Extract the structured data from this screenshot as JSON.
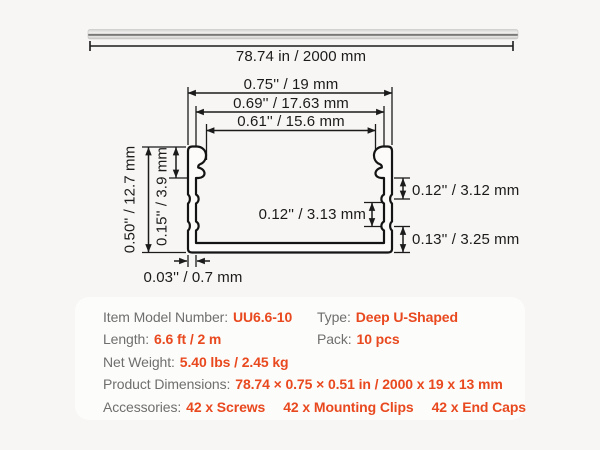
{
  "colors": {
    "background": "#F7F6F4",
    "panel": "#FCFCFA",
    "accent_orange": "#E9491F",
    "label_gray": "#6F6F6F",
    "line_ink": "#1B1B1B"
  },
  "diagram": {
    "length_label": "78.74 in / 2000 mm",
    "dims": {
      "width_outer": "0.75'' / 19 mm",
      "width_mid": "0.69'' / 17.63 mm",
      "width_inner": "0.61'' / 15.6 mm",
      "height_outer": "0.50'' / 12.7 mm",
      "flange_height": "0.15'' / 3.9 mm",
      "wall_thickness": "0.03'' / 0.7 mm",
      "seg_top_right": "0.12'' / 3.12 mm",
      "seg_mid": "0.12'' / 3.13 mm",
      "seg_bottom_right": "0.13'' / 3.25 mm"
    }
  },
  "specs": {
    "model": {
      "label": "Item Model Number:",
      "value": "UU6.6-10"
    },
    "type": {
      "label": "Type:",
      "value": "Deep U-Shaped"
    },
    "length": {
      "label": "Length:",
      "value": "6.6 ft / 2 m"
    },
    "pack": {
      "label": "Pack:",
      "value": "10 pcs"
    },
    "net_weight": {
      "label": "Net Weight:",
      "value": "5.40 lbs / 2.45 kg"
    },
    "product_dimensions": {
      "label": "Product Dimensions:",
      "value": "78.74 × 0.75 × 0.51 in / 2000 x 19 x 13 mm"
    },
    "accessories": {
      "label": "Accessories:",
      "items": [
        "42 x Screws",
        "42 x Mounting Clips",
        "42 x End Caps"
      ]
    }
  }
}
